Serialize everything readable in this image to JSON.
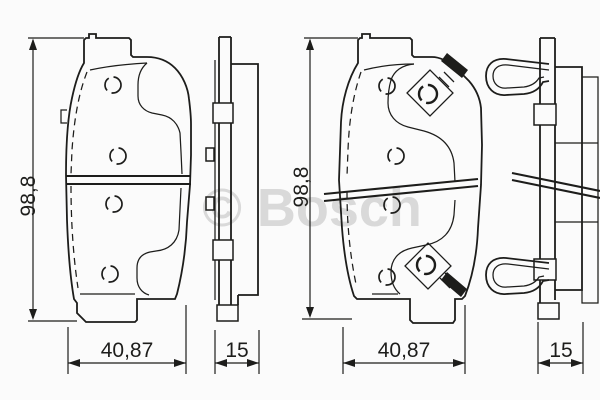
{
  "drawing": {
    "watermark": "© Bosch",
    "colors": {
      "background": "#fbfbfb",
      "line": "#1d1d1b",
      "watermark": "#d9d9d9"
    },
    "dimensions": {
      "left_height": "98,8",
      "left_width": "40,87",
      "left_thickness": "15",
      "right_height": "98,8",
      "right_width": "40,87",
      "right_thickness": "15"
    }
  }
}
